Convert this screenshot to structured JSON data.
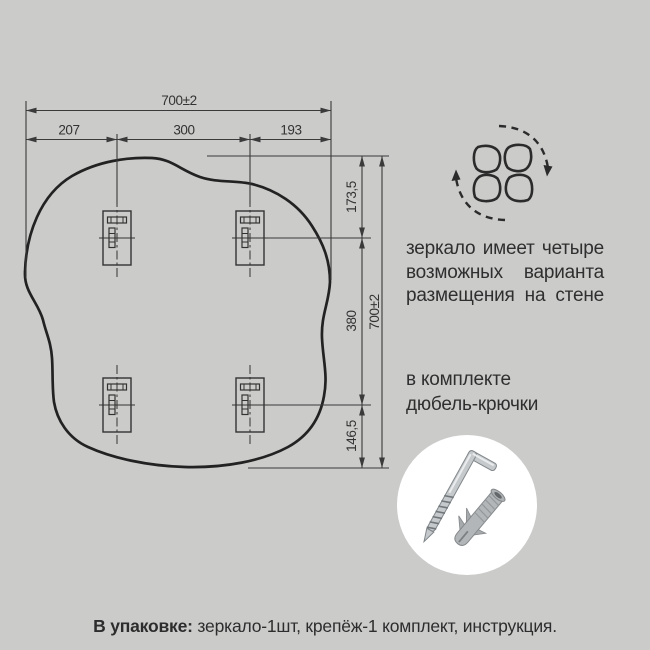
{
  "colors": {
    "background": "#cbcbca",
    "drawing_line": "#2e2e2e",
    "dimension_line": "#3a3a3a",
    "text": "#2f2f2f",
    "photo_circle_background": "#ffffff",
    "metal": "#c5c9cc",
    "dowel_plastic": "#b3b6b8"
  },
  "dimensions": {
    "total_width": "700±2",
    "left_offset": "207",
    "center_span": "300",
    "right_offset": "193",
    "top_offset": "173,5",
    "middle_span": "380",
    "bottom_offset": "146,5",
    "total_height": "700±2"
  },
  "icons": {
    "rotation_icon": "four-orientation-rotation-icon",
    "fasteners_photo": "hook-screw-and-dowel-photo"
  },
  "notes": {
    "placement_line1": "зеркало имеет четыре",
    "placement_line2": "возможных варианта",
    "placement_line3": "размещения на стене",
    "included_line1": "в комплекте",
    "included_line2": "дюбель-крючки"
  },
  "package": {
    "label": "В упаковке:",
    "contents": " зеркало-1шт, крепёж-1 комплект, инструкция."
  }
}
